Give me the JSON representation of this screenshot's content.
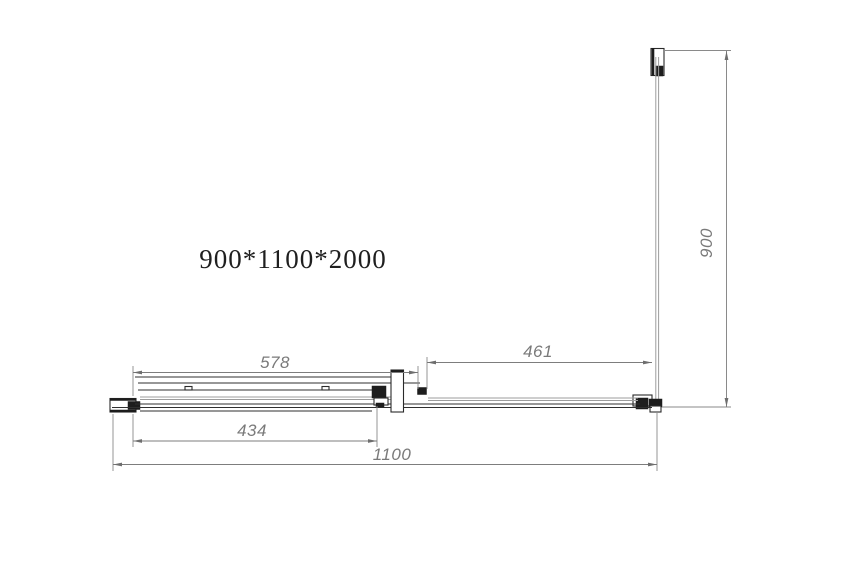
{
  "drawing": {
    "title": "900*1100*2000",
    "dimensions": {
      "top_rail_width": "578",
      "fixed_panel_width": "461",
      "door_panel_width": "434",
      "total_width": "1100",
      "side_depth": "900"
    },
    "colors": {
      "outline": "#2f2f2f",
      "glass_line": "#9c9c9c",
      "dimension_line": "#7d7d7d",
      "dimension_text": "#7a7a7a",
      "title_text": "#1f1f1f",
      "background": "#ffffff"
    }
  }
}
